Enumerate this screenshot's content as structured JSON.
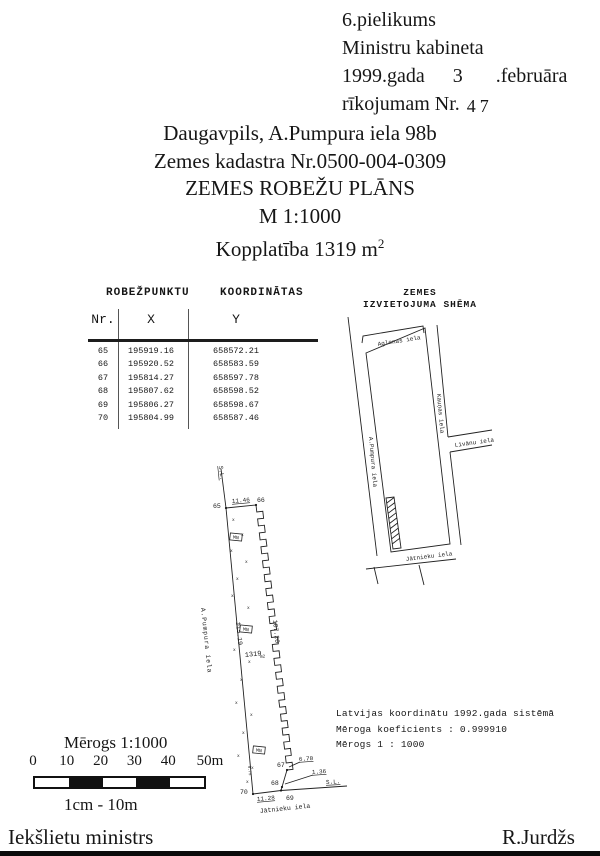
{
  "header": {
    "line1": "6.pielikums",
    "line2": "Ministru kabineta",
    "date_prefix": "1999.gada",
    "date_day": "3",
    "date_suffix": ".februāra",
    "nr_prefix": "rīkojumam Nr.",
    "nr_value": "47"
  },
  "title": {
    "address": "Daugavpils, A.Pumpura iela 98b",
    "cadastre": "Zemes kadastra Nr.0500-004-0309",
    "plan_title": "ZEMES ROBEŽU PLĀNS",
    "scale": "M 1:1000",
    "area_prefix": "Kopplatība 1319 m",
    "area_sup": "2"
  },
  "table": {
    "caption": "ROBEŽPUNKTU    KOORDINĀTAS",
    "columns": [
      "Nr.",
      "X",
      "Y"
    ],
    "rows": [
      [
        "65",
        "195919.16",
        "658572.21"
      ],
      [
        "66",
        "195920.52",
        "658583.59"
      ],
      [
        "67",
        "195814.27",
        "658597.78"
      ],
      [
        "68",
        "195807.62",
        "658598.52"
      ],
      [
        "69",
        "195806.27",
        "658598.67"
      ],
      [
        "70",
        "195804.99",
        "658587.46"
      ]
    ]
  },
  "schema": {
    "title_line1": "ZEMES",
    "title_line2": "IZVIETOJUMA SHĒMA",
    "streets": {
      "aglonas": "Aglonas iela",
      "kaunas": "Kauņas iela",
      "livanu": "Līvānu iela",
      "pumpura": "A.Pumpura iela",
      "jatnieku": "Jātnieku iela"
    }
  },
  "plan": {
    "points": {
      "p65": "65",
      "p66": "66",
      "p67": "67",
      "p68": "68",
      "p69": "69",
      "p70": "70"
    },
    "dims": {
      "d65_66": "11.46",
      "d66_67": "107.20",
      "d65_70": "115.19",
      "d67_68": "6.70",
      "d68_69": "1.36",
      "d69_70": "11.28",
      "small": "0.75"
    },
    "labels": {
      "area": "1319",
      "area_unit": "m2",
      "marker": "MN",
      "sl": "S.L.",
      "street_west": "A.Pumpura iela",
      "street_south": "Jātnieku iela"
    }
  },
  "notes": {
    "line1": "Latvijas koordinātu 1992.gada sistēmā",
    "line2": "Mēroga koeficients : 0.999910",
    "line3": "Mērogs 1 : 1000"
  },
  "scalebar": {
    "title": "Mērogs 1:1000",
    "ticks": [
      "0",
      "10",
      "20",
      "30",
      "40",
      "50m"
    ],
    "caption": "1cm - 10m"
  },
  "footer": {
    "left": "Iekšlietu ministrs",
    "right": "R.Jurdžs"
  },
  "colors": {
    "ink": "#161616",
    "paper": "#ffffff"
  }
}
